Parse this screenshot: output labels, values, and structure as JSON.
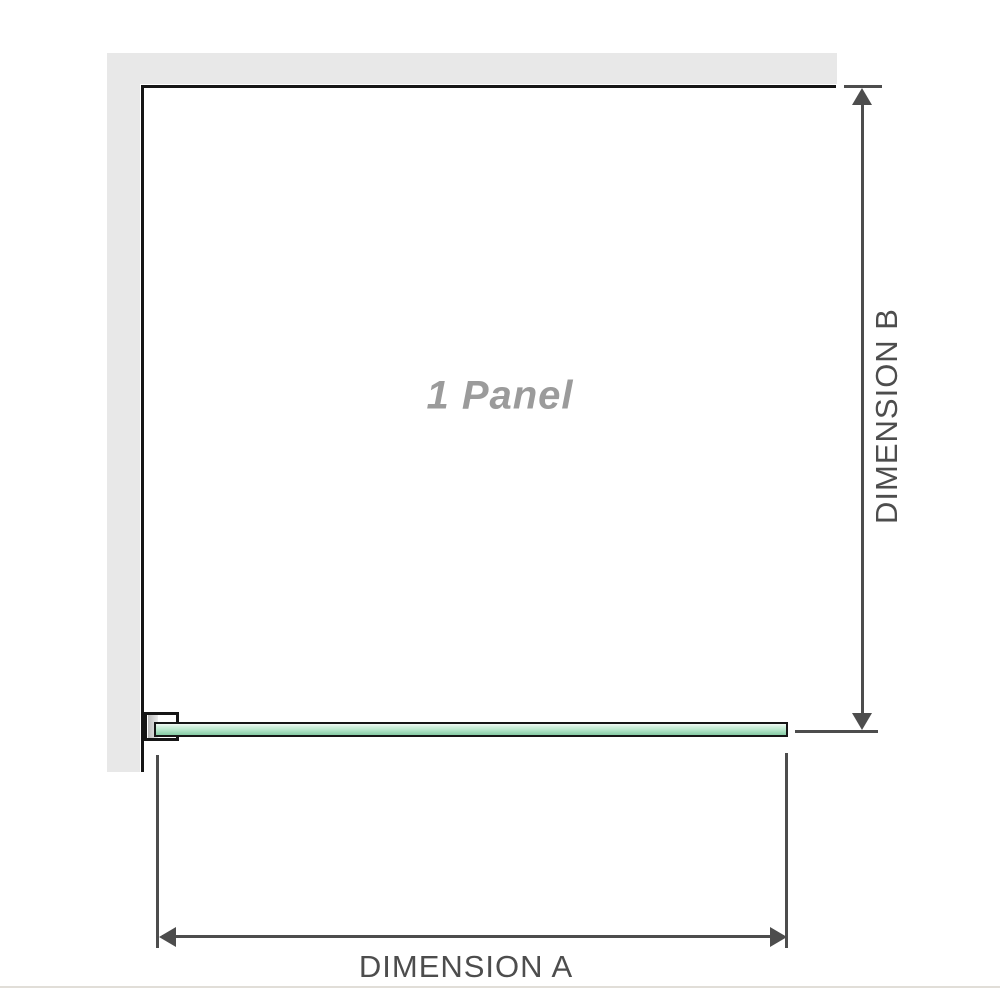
{
  "diagram": {
    "panel": {
      "label": "1 Panel"
    },
    "dimensions": [
      {
        "id": "A",
        "label": "DIMENSION A",
        "orientation": "horizontal"
      },
      {
        "id": "B",
        "label": "DIMENSION B",
        "orientation": "vertical"
      }
    ],
    "colors": {
      "wall": "#e8e8e8",
      "outline": "#161616",
      "dimension": "#4d4d4d",
      "label_text": "#4d4d4d",
      "panel_label_text": "#9b9b9b",
      "glass_top": "#f2faf5",
      "glass_mid": "#b5e5c9",
      "glass_bottom": "#85cba4",
      "baseline": "#e1ded8",
      "page_bg": "#ffffff"
    }
  }
}
